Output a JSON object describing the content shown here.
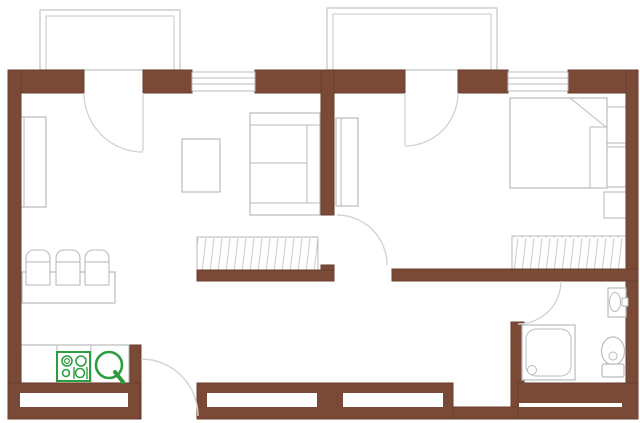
{
  "canvas": {
    "width": 640,
    "height": 423
  },
  "colors": {
    "wall": "#7b4a37",
    "wallEdge": "#6a3d2c",
    "white": "#ffffff",
    "furn": "#b7bbbf",
    "balc": "#c9cccf",
    "arc": "#d4d4d4",
    "hatch": "#c8cbce",
    "green": "#2d9e40"
  },
  "elements": [
    {
      "name": "balcony-left-outer",
      "kind": "rect",
      "x": 40,
      "y": 10,
      "w": 140,
      "h": 60,
      "stroke": "balc",
      "sw": 1.4
    },
    {
      "name": "balcony-left-inner",
      "kind": "rect",
      "x": 46,
      "y": 16,
      "w": 128,
      "h": 54,
      "stroke": "balc",
      "sw": 1.1
    },
    {
      "name": "balcony-right-outer",
      "kind": "rect",
      "x": 327,
      "y": 8,
      "w": 170,
      "h": 62,
      "stroke": "balc",
      "sw": 1.4
    },
    {
      "name": "balcony-right-inner",
      "kind": "rect",
      "x": 333,
      "y": 14,
      "w": 158,
      "h": 56,
      "stroke": "balc",
      "sw": 1.1
    },
    {
      "name": "cabinet-living",
      "kind": "rect",
      "x": 20,
      "y": 117,
      "w": 26,
      "h": 90,
      "stroke": "furn",
      "sw": 1.2,
      "fill": "white"
    },
    {
      "name": "cabinet-living-door-line",
      "kind": "line",
      "x1": 24,
      "y1": 117,
      "x2": 24,
      "y2": 207,
      "stroke": "furn",
      "sw": 1
    },
    {
      "name": "coffee-table",
      "kind": "rect",
      "x": 182,
      "y": 139,
      "w": 38,
      "h": 53,
      "stroke": "furn",
      "sw": 1.2,
      "fill": "white"
    },
    {
      "name": "sofa",
      "kind": "rect",
      "x": 250,
      "y": 113,
      "w": 70,
      "h": 102,
      "stroke": "furn",
      "sw": 1.2,
      "fill": "white"
    },
    {
      "name": "sofa-armrest-top-line",
      "kind": "line",
      "x1": 250,
      "y1": 125,
      "x2": 320,
      "y2": 125,
      "stroke": "furn",
      "sw": 1
    },
    {
      "name": "sofa-armrest-bottom-line",
      "kind": "line",
      "x1": 250,
      "y1": 203,
      "x2": 320,
      "y2": 203,
      "stroke": "furn",
      "sw": 1
    },
    {
      "name": "sofa-backrest-line",
      "kind": "line",
      "x1": 307,
      "y1": 125,
      "x2": 307,
      "y2": 203,
      "stroke": "furn",
      "sw": 1
    },
    {
      "name": "sofa-cushion-line",
      "kind": "line",
      "x1": 250,
      "y1": 163,
      "x2": 307,
      "y2": 163,
      "stroke": "furn",
      "sw": 1
    },
    {
      "name": "dining-table",
      "kind": "rect",
      "x": 22,
      "y": 272,
      "w": 93,
      "h": 31,
      "stroke": "furn",
      "sw": 1.2,
      "fill": "white"
    },
    {
      "name": "chair-1-back",
      "kind": "rect",
      "x": 26,
      "y": 250,
      "w": 24,
      "h": 17,
      "rx": 8,
      "stroke": "furn",
      "sw": 1.1,
      "fill": "white"
    },
    {
      "name": "chair-1-seat",
      "kind": "rect",
      "x": 26,
      "y": 262,
      "w": 24,
      "h": 23,
      "stroke": "furn",
      "sw": 1.1,
      "fill": "white"
    },
    {
      "name": "chair-2-back",
      "kind": "rect",
      "x": 56,
      "y": 250,
      "w": 24,
      "h": 17,
      "rx": 8,
      "stroke": "furn",
      "sw": 1.1,
      "fill": "white"
    },
    {
      "name": "chair-2-seat",
      "kind": "rect",
      "x": 56,
      "y": 262,
      "w": 24,
      "h": 23,
      "stroke": "furn",
      "sw": 1.1,
      "fill": "white"
    },
    {
      "name": "chair-3-back",
      "kind": "rect",
      "x": 85,
      "y": 250,
      "w": 24,
      "h": 17,
      "rx": 8,
      "stroke": "furn",
      "sw": 1.1,
      "fill": "white"
    },
    {
      "name": "chair-3-seat",
      "kind": "rect",
      "x": 85,
      "y": 262,
      "w": 24,
      "h": 23,
      "stroke": "furn",
      "sw": 1.1,
      "fill": "white"
    },
    {
      "name": "kitchen-counter",
      "kind": "rect",
      "x": 21,
      "y": 345,
      "w": 108,
      "h": 38,
      "stroke": "furn",
      "sw": 1.2,
      "fill": "white"
    },
    {
      "name": "kitchen-counter-divider-1",
      "kind": "line",
      "x1": 57,
      "y1": 345,
      "x2": 57,
      "y2": 383,
      "stroke": "furn",
      "sw": 1
    },
    {
      "name": "kitchen-counter-divider-2",
      "kind": "line",
      "x1": 91,
      "y1": 345,
      "x2": 91,
      "y2": 383,
      "stroke": "furn",
      "sw": 1
    },
    {
      "name": "cabinet-bedroom",
      "kind": "rect",
      "x": 336,
      "y": 118,
      "w": 22,
      "h": 88,
      "stroke": "furn",
      "sw": 1.2,
      "fill": "white"
    },
    {
      "name": "cabinet-bedroom-door-line",
      "kind": "line",
      "x1": 341,
      "y1": 118,
      "x2": 341,
      "y2": 206,
      "stroke": "furn",
      "sw": 1
    },
    {
      "name": "bed",
      "kind": "rect",
      "x": 510,
      "y": 98,
      "w": 97,
      "h": 90,
      "stroke": "furn",
      "sw": 1.2,
      "fill": "white"
    },
    {
      "name": "bed-blanket-fold-line",
      "kind": "line",
      "x1": 570,
      "y1": 98,
      "x2": 606,
      "y2": 127,
      "stroke": "furn",
      "sw": 1
    },
    {
      "name": "bed-blanket-edge-line",
      "kind": "line",
      "x1": 590,
      "y1": 127,
      "x2": 590,
      "y2": 188,
      "stroke": "furn",
      "sw": 1
    },
    {
      "name": "bed-pillow-line",
      "kind": "line",
      "x1": 590,
      "y1": 127,
      "x2": 607,
      "y2": 127,
      "stroke": "furn",
      "sw": 1
    },
    {
      "name": "nightstand-1",
      "kind": "rect",
      "x": 607,
      "y": 107,
      "w": 20,
      "h": 36,
      "stroke": "furn",
      "sw": 1.1,
      "fill": "white"
    },
    {
      "name": "nightstand-2",
      "kind": "rect",
      "x": 607,
      "y": 147,
      "w": 20,
      "h": 40,
      "stroke": "furn",
      "sw": 1.1,
      "fill": "white"
    },
    {
      "name": "bedside-stool",
      "kind": "rect",
      "x": 604,
      "y": 192,
      "w": 23,
      "h": 26,
      "stroke": "furn",
      "sw": 1.1,
      "fill": "white"
    },
    {
      "name": "closet-living-hatched",
      "kind": "rect",
      "x": 197,
      "y": 237,
      "w": 121,
      "h": 33,
      "stroke": "furn",
      "sw": 1,
      "fill": "pattern"
    },
    {
      "name": "closet-bedroom-hatched",
      "kind": "rect",
      "x": 512,
      "y": 236,
      "w": 114,
      "h": 34,
      "stroke": "furn",
      "sw": 1,
      "fill": "pattern"
    },
    {
      "name": "wall-top-1",
      "kind": "rect",
      "x": 8,
      "y": 70,
      "w": 76,
      "h": 23,
      "fill": "wall",
      "stroke": "wallEdge",
      "sw": 1
    },
    {
      "name": "wall-top-2",
      "kind": "rect",
      "x": 143,
      "y": 70,
      "w": 49,
      "h": 23,
      "fill": "wall",
      "stroke": "wallEdge",
      "sw": 1
    },
    {
      "name": "wall-top-3",
      "kind": "rect",
      "x": 255,
      "y": 70,
      "w": 150,
      "h": 23,
      "fill": "wall",
      "stroke": "wallEdge",
      "sw": 1
    },
    {
      "name": "wall-top-4",
      "kind": "rect",
      "x": 458,
      "y": 70,
      "w": 50,
      "h": 23,
      "fill": "wall",
      "stroke": "wallEdge",
      "sw": 1
    },
    {
      "name": "wall-top-5",
      "kind": "rect",
      "x": 568,
      "y": 70,
      "w": 70,
      "h": 23,
      "fill": "wall",
      "stroke": "wallEdge",
      "sw": 1
    },
    {
      "name": "wall-left",
      "kind": "rect",
      "x": 8,
      "y": 70,
      "w": 13,
      "h": 349,
      "fill": "wall",
      "stroke": "wallEdge",
      "sw": 1
    },
    {
      "name": "wall-right",
      "kind": "rect",
      "x": 626,
      "y": 70,
      "w": 12,
      "h": 349,
      "fill": "wall",
      "stroke": "wallEdge",
      "sw": 1
    },
    {
      "name": "wall-partition-upper",
      "kind": "rect",
      "x": 321,
      "y": 70,
      "w": 13,
      "h": 145,
      "fill": "wall",
      "stroke": "wallEdge",
      "sw": 1
    },
    {
      "name": "wall-partition-lower",
      "kind": "rect",
      "x": 321,
      "y": 265,
      "w": 13,
      "h": 16,
      "fill": "wall",
      "stroke": "wallEdge",
      "sw": 1
    },
    {
      "name": "wall-living-closet",
      "kind": "rect",
      "x": 197,
      "y": 270,
      "w": 137,
      "h": 11,
      "fill": "wall",
      "stroke": "wallEdge",
      "sw": 1
    },
    {
      "name": "wall-corridor",
      "kind": "rect",
      "x": 392,
      "y": 269,
      "w": 246,
      "h": 12,
      "fill": "wall",
      "stroke": "wallEdge",
      "sw": 1
    },
    {
      "name": "wall-bathroom-west",
      "kind": "rect",
      "x": 511,
      "y": 322,
      "w": 13,
      "h": 85,
      "fill": "wall",
      "stroke": "wallEdge",
      "sw": 1
    },
    {
      "name": "wall-kitchen-stub",
      "kind": "rect",
      "x": 130,
      "y": 345,
      "w": 11,
      "h": 74,
      "fill": "wall",
      "stroke": "wallEdge",
      "sw": 1
    },
    {
      "name": "wall-bottom-left",
      "kind": "rect",
      "x": 8,
      "y": 383,
      "w": 132,
      "h": 36,
      "fill": "wall",
      "stroke": "wallEdge",
      "sw": 1
    },
    {
      "name": "wall-bottom-left-window-inset",
      "kind": "rect",
      "x": 20,
      "y": 393,
      "w": 108,
      "h": 14,
      "fill": "white"
    },
    {
      "name": "wall-bottom-mid",
      "kind": "rect",
      "x": 197,
      "y": 383,
      "w": 256,
      "h": 36,
      "fill": "wall",
      "stroke": "wallEdge",
      "sw": 1
    },
    {
      "name": "wall-bottom-mid-window-inset-1",
      "kind": "rect",
      "x": 207,
      "y": 393,
      "w": 110,
      "h": 14,
      "fill": "white"
    },
    {
      "name": "wall-bottom-mid-window-inset-2",
      "kind": "rect",
      "x": 343,
      "y": 393,
      "w": 100,
      "h": 14,
      "fill": "white"
    },
    {
      "name": "wall-bottom-hall",
      "kind": "rect",
      "x": 453,
      "y": 407,
      "w": 65,
      "h": 12,
      "fill": "wall",
      "stroke": "wallEdge",
      "sw": 1
    },
    {
      "name": "wall-bottom-bathroom",
      "kind": "rect",
      "x": 518,
      "y": 383,
      "w": 120,
      "h": 36,
      "fill": "wall",
      "stroke": "wallEdge",
      "sw": 1
    },
    {
      "name": "wall-bottom-bathroom-seam",
      "kind": "rect",
      "x": 519,
      "y": 403,
      "w": 103,
      "h": 4,
      "fill": "white"
    },
    {
      "name": "window-top-left",
      "kind": "rect",
      "x": 192,
      "y": 72,
      "w": 63,
      "h": 19,
      "stroke": "furn",
      "sw": 1,
      "fill": "white"
    },
    {
      "name": "window-top-left-glaze-1",
      "kind": "line",
      "x1": 192,
      "y1": 78,
      "x2": 255,
      "y2": 78,
      "stroke": "furn",
      "sw": 1
    },
    {
      "name": "window-top-left-glaze-2",
      "kind": "line",
      "x1": 192,
      "y1": 84,
      "x2": 255,
      "y2": 84,
      "stroke": "furn",
      "sw": 1
    },
    {
      "name": "window-top-right",
      "kind": "rect",
      "x": 508,
      "y": 72,
      "w": 60,
      "h": 19,
      "stroke": "furn",
      "sw": 1,
      "fill": "white"
    },
    {
      "name": "window-top-right-glaze-1",
      "kind": "line",
      "x1": 508,
      "y1": 78,
      "x2": 568,
      "y2": 78,
      "stroke": "furn",
      "sw": 1
    },
    {
      "name": "window-top-right-glaze-2",
      "kind": "line",
      "x1": 508,
      "y1": 84,
      "x2": 568,
      "y2": 84,
      "stroke": "furn",
      "sw": 1
    },
    {
      "name": "door-living-leaf",
      "kind": "line",
      "x1": 143,
      "y1": 93,
      "x2": 143,
      "y2": 151,
      "stroke": "arc",
      "sw": 1.4
    },
    {
      "name": "door-living-swing-arc",
      "kind": "path",
      "d": "M84,93 A59,59 0 0 0 143,152",
      "stroke": "arc",
      "sw": 1.4
    },
    {
      "name": "door-bedroom-leaf",
      "kind": "line",
      "x1": 405,
      "y1": 93,
      "x2": 405,
      "y2": 145,
      "stroke": "arc",
      "sw": 1.4
    },
    {
      "name": "door-bedroom-swing-arc",
      "kind": "path",
      "d": "M458,93 A53,53 0 0 1 405,146",
      "stroke": "arc",
      "sw": 1.4
    },
    {
      "name": "door-corridor-swing-arc",
      "kind": "path",
      "d": "M337,215 A50,50 0 0 1 387,265",
      "stroke": "arc",
      "sw": 1.4
    },
    {
      "name": "door-bathroom-swing-arc",
      "kind": "path",
      "d": "M561,281 A43,43 0 0 1 518,324",
      "stroke": "arc",
      "sw": 1.4
    },
    {
      "name": "door-entry-swing-arc",
      "kind": "path",
      "d": "M141,359 A57,57 0 0 1 198,416",
      "stroke": "arc",
      "sw": 1.4
    },
    {
      "name": "shower-tray",
      "kind": "rect",
      "x": 522,
      "y": 325,
      "w": 53,
      "h": 55,
      "stroke": "furn",
      "sw": 1.2,
      "fill": "white"
    },
    {
      "name": "shower-tray-inner",
      "kind": "rect",
      "x": 526,
      "y": 329,
      "w": 45,
      "h": 47,
      "rx": 10,
      "stroke": "furn",
      "sw": 1
    },
    {
      "name": "shower-drain",
      "kind": "circle",
      "cx": 532,
      "cy": 370,
      "r": 4.5,
      "stroke": "furn",
      "sw": 1,
      "fill": "white"
    },
    {
      "name": "toilet-bowl",
      "kind": "ellipse",
      "cx": 613,
      "cy": 351,
      "rx": 11.5,
      "ry": 14,
      "stroke": "furn",
      "sw": 1.2,
      "fill": "white"
    },
    {
      "name": "toilet-flush-button",
      "kind": "circle",
      "cx": 613,
      "cy": 356,
      "r": 4,
      "stroke": "furn",
      "sw": 1,
      "fill": "white"
    },
    {
      "name": "toilet-tank",
      "kind": "rect",
      "x": 602,
      "y": 364,
      "w": 22,
      "h": 13,
      "rx": 2,
      "stroke": "furn",
      "sw": 1.2,
      "fill": "white"
    },
    {
      "name": "bathroom-sink",
      "kind": "rect",
      "x": 608,
      "y": 288,
      "w": 18,
      "h": 29,
      "stroke": "furn",
      "sw": 1.2,
      "fill": "white"
    },
    {
      "name": "bathroom-sink-bowl",
      "kind": "ellipse",
      "cx": 615,
      "cy": 302,
      "rx": 5.5,
      "ry": 9.5,
      "stroke": "furn",
      "sw": 1,
      "fill": "white"
    },
    {
      "name": "bathroom-sink-faucet",
      "kind": "rect",
      "x": 622,
      "y": 298,
      "w": 6,
      "h": 8,
      "stroke": "furn",
      "sw": 1,
      "fill": "white"
    },
    {
      "name": "stove-symbol",
      "kind": "rect",
      "x": 57,
      "y": 352,
      "w": 33,
      "h": 29,
      "stroke": "green",
      "sw": 2,
      "fill": "white"
    },
    {
      "name": "stove-burner-top-left",
      "kind": "circle",
      "cx": 67,
      "cy": 361,
      "r": 5,
      "stroke": "green",
      "sw": 1.6
    },
    {
      "name": "stove-burner-top-left-inner",
      "kind": "circle",
      "cx": 67,
      "cy": 361,
      "r": 2.4,
      "stroke": "green",
      "sw": 1.2
    },
    {
      "name": "stove-burner-top-right",
      "kind": "circle",
      "cx": 81,
      "cy": 361,
      "r": 5,
      "stroke": "green",
      "sw": 1.6
    },
    {
      "name": "stove-burner-bottom-left",
      "kind": "circle",
      "cx": 66,
      "cy": 373,
      "r": 3.5,
      "stroke": "green",
      "sw": 1.6
    },
    {
      "name": "stove-burner-bottom-right",
      "kind": "circle",
      "cx": 80,
      "cy": 373,
      "r": 4.5,
      "stroke": "green",
      "sw": 1.6
    },
    {
      "name": "stove-bracket-left",
      "kind": "line",
      "x1": 74,
      "y1": 367,
      "x2": 74,
      "y2": 379,
      "stroke": "green",
      "sw": 1.4
    },
    {
      "name": "stove-bracket-right",
      "kind": "line",
      "x1": 87,
      "y1": 367,
      "x2": 87,
      "y2": 379,
      "stroke": "green",
      "sw": 1.4
    },
    {
      "name": "kitchen-sink-symbol",
      "kind": "circle",
      "cx": 109,
      "cy": 365,
      "r": 13,
      "stroke": "green",
      "sw": 2.6,
      "fill": "white"
    },
    {
      "name": "kitchen-sink-symbol-tail",
      "kind": "line",
      "x1": 115,
      "y1": 372,
      "x2": 123,
      "y2": 382,
      "stroke": "green",
      "sw": 4,
      "cap": "round"
    }
  ]
}
